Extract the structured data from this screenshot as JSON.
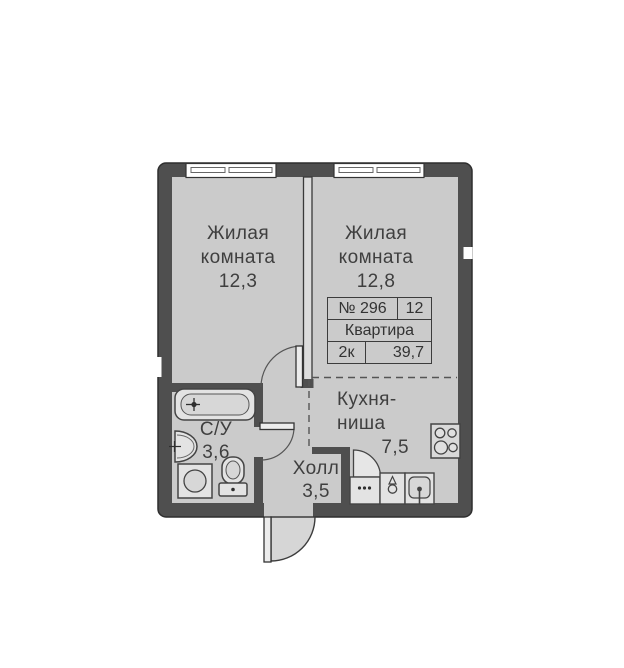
{
  "colors": {
    "wall": "#4f4f4f",
    "floor": "#cbcbcb",
    "fixture_fill": "#e3e3e3",
    "outline": "#444444",
    "text": "#3f3f3f"
  },
  "info_table": {
    "number": "№ 296",
    "section": "12",
    "title": "Квартира",
    "rooms": "2к",
    "area": "39,7"
  },
  "rooms": {
    "living1": {
      "line1": "Жилая",
      "line2": "комната",
      "area": "12,3"
    },
    "living2": {
      "line1": "Жилая",
      "line2": "комната",
      "area": "12,8"
    },
    "kitchen": {
      "line1": "Кухня-",
      "line2": "ниша",
      "area": "7,5"
    },
    "hall": {
      "name": "Холл",
      "area": "3,5"
    },
    "bathroom": {
      "name": "С/У",
      "area": "3,6"
    }
  },
  "fixtures": [
    "window",
    "window",
    "bathtub",
    "bathroom-sink",
    "washing-machine",
    "toilet",
    "stove",
    "kitchen-cabinet",
    "kitchen-faucet-cabinet",
    "kitchen-sink",
    "entrance-door",
    "room-door",
    "bathroom-door"
  ]
}
